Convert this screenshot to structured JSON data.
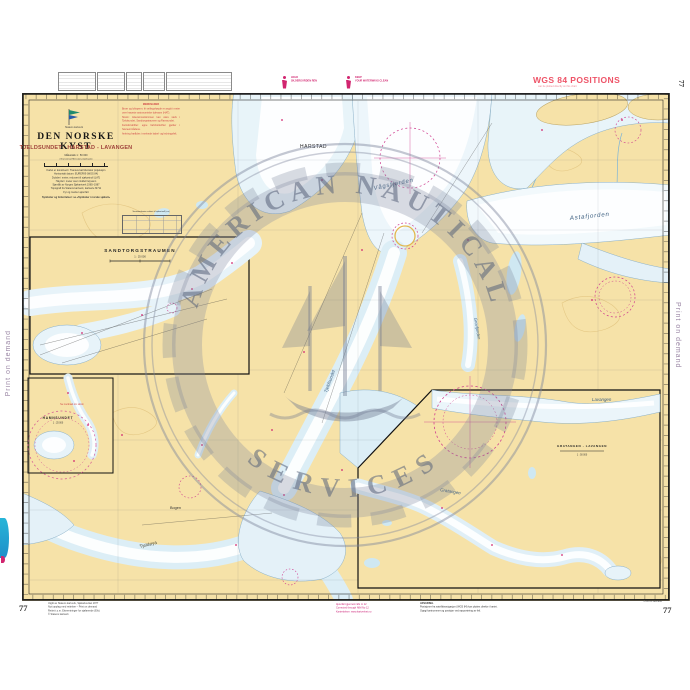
{
  "edge": {
    "left": "Print on demand",
    "right": "Print on demand"
  },
  "chart_number": "77",
  "header": {
    "slogan_no_1": "HOLD",
    "slogan_no_2": "SKJÆRGÅRDEN REN",
    "slogan_en_1": "KEEP",
    "slogan_en_2": "YOUR WATERWAYS CLEAN",
    "wgs_title": "WGS 84 POSITIONS",
    "wgs_sub": "can be plotted directly on this chart"
  },
  "title_block": {
    "agency": "Statens kartverk",
    "series": "DEN NORSKE KYST",
    "title": "TJELDSUNDET - HARSTAD - LAVANGEN",
    "scale": "Målestokk 1 : 50 000",
    "projection": "(Transversal Mercator projeksjon)",
    "info_lines": [
      "Kartet er konstruert i Transversal Mercator projeksjon",
      "Horisontalt datum: EUREF89 (WGS 84)",
      "Dybder i meter, redusert til sjøkartnull (LAT)",
      "Høyder i meter over middel høyvann",
      "Sjømålt av Norges Sjøkartverk 1965–1987",
      "Topografi fra Statens kartverk, kartserie M711",
      "Fyr og merker ajourført"
    ],
    "symbols_line": "Symboler og forkortelser: se «Symboler i norske sjøkart»",
    "red_notes": [
      "MERKNADER",
      "Broer og luftspenn: fri seilingshøyde er angitt i meter over høyeste astronomiske tidevann (HAT).",
      "Strøm: tidevannsstrømmen kan være sterk i Tjeldsundet, Sandtorgstraumen og Ramsundet.",
      "Fartsforskrifter: egne fartsforskrifter gjelder i havneområdene.",
      "Ankring frarådes i merkede kabel- og ledningsfelt."
    ],
    "table_title": "Vannstandsnivå relatert til sjøkartnull (cm)"
  },
  "insets": {
    "inset1": {
      "title": "SANDTORGSTRAUMEN",
      "scale": "1 : 25 000"
    },
    "inset2": {
      "title": "HAMNSUNDET",
      "scale": "1 : 25 000",
      "note": "Se merknad om strøm"
    },
    "inset3": {
      "title": "GRATANGEN - LAVANGEN",
      "scale": "1 : 50 000"
    }
  },
  "labels": {
    "l0": "HARSTAD",
    "l1": "Vågsfjorden",
    "l2": "Astafjorden",
    "l3": "Tjeldsundet",
    "l4": "Grovfjorden",
    "l5": "Lavangen",
    "l6": "Gratangen",
    "l7": "Tjeldøya",
    "l8": "Bogen"
  },
  "watermark": {
    "top": "AMERICAN NAUTICAL",
    "bottom": "SERVICES"
  },
  "footer": {
    "left_lines": [
      "Utgitt av Statens kartverk, Sjøkartverket 1977",
      "Nytt opplag med rettelser – Print on demand",
      "Rettet t.o.m. Etterretninger for sjøfarende (Efs)",
      "© Statens kartverk"
    ],
    "magenta_lines": [
      "Ajourført gjennom Efs nr 12",
      "Corrected through NtM No 12",
      "Kartrettelser: www.kartverket.no"
    ],
    "notice_lines": [
      "ADVARSEL",
      "Posisjoner fra satellittnavigasjon (WGS 84) kan plottes direkte i kartet.",
      "Oppgi kartnummer og posisjon ved rapportering av feil."
    ],
    "right_line": "Print on demand"
  },
  "colors": {
    "land": "#f6e2a8",
    "shallow": "#dceef6",
    "magenta": "#cf3d8f",
    "red_note": "#cf4646"
  }
}
